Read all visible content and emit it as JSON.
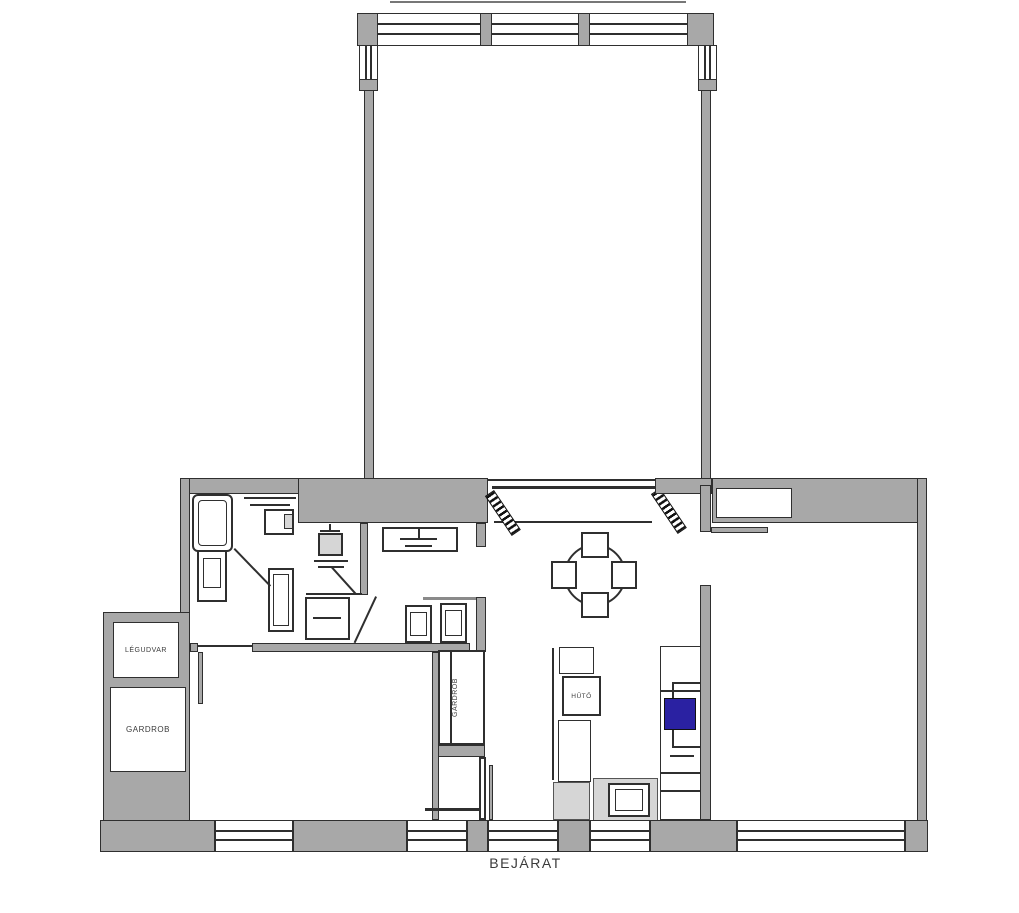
{
  "type": "floor-plan",
  "labels": {
    "light_well": "LÉGUDVAR",
    "wardrobe_room": "GARDROB",
    "hall_wardrobe": "GARDROB",
    "fridge": "HŰTŐ",
    "entrance": "BEJÁRAT"
  },
  "colors": {
    "wall": "#a8a8a8",
    "wall_light": "#d6d6d6",
    "line": "#2f2f2f",
    "accent": "#2a21a2",
    "background": "#ffffff",
    "text": "#3b3b3b"
  }
}
